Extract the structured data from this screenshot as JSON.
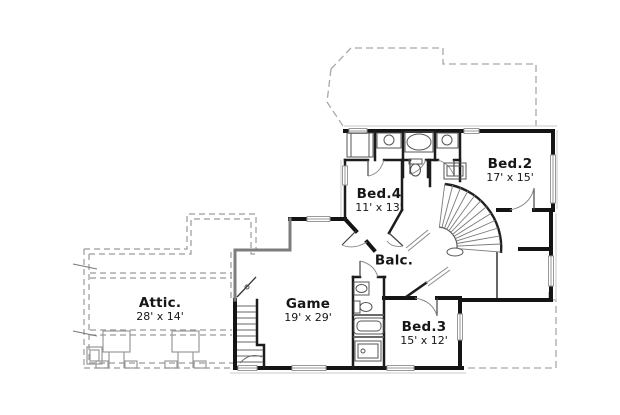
{
  "floor_plan": {
    "background": "#ffffff",
    "wall_color": "#141414",
    "roof_dash_color": "#a8a8a8",
    "window_color": "#999999",
    "rooms": [
      {
        "name": "Attic.",
        "dims": "28' x 14'"
      },
      {
        "name": "Game",
        "dims": "19' x 29'"
      },
      {
        "name": "Balc.",
        "dims": ""
      },
      {
        "name": "Bed.4",
        "dims": "11' x 13'"
      },
      {
        "name": "Bed.2",
        "dims": "17' x 15'"
      },
      {
        "name": "Bed.3",
        "dims": "15' x 12'"
      }
    ]
  }
}
